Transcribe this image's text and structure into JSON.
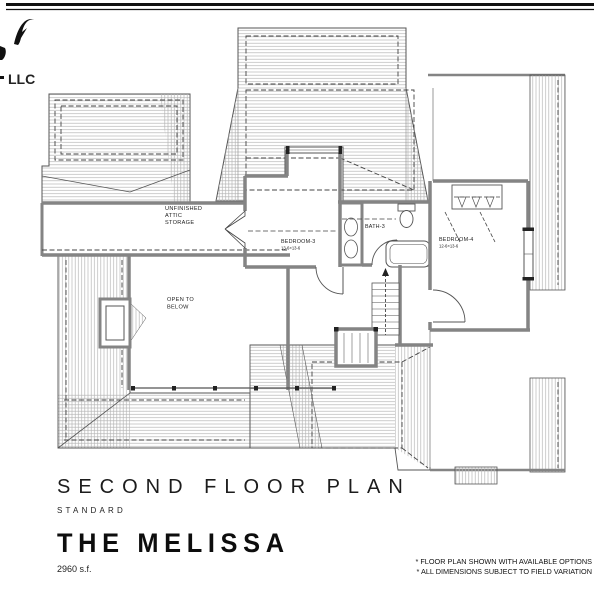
{
  "page": {
    "logo_suffix": "LLC",
    "title": "SECOND FLOOR PLAN",
    "subtitle": "STANDARD",
    "plan_name": "THE MELISSA",
    "area": "2960 s.f.",
    "notes": [
      "* FLOOR PLAN SHOWN WITH AVAILABLE OPTIONS",
      "* ALL DIMENSIONS SUBJECT TO FIELD VARIATION"
    ]
  },
  "rooms": {
    "attic": {
      "l1": "UNFINISHED",
      "l2": "ATTIC",
      "l3": "STORAGE"
    },
    "open_below": {
      "l1": "OPEN TO",
      "l2": "BELOW"
    },
    "bedroom3": {
      "name": "BEDROOM-3",
      "dims": "13-6×13-6"
    },
    "bath3": {
      "name": "BATH-3"
    },
    "bedroom4": {
      "name": "BEDROOM-4",
      "dims": "12-6×13-6"
    }
  },
  "colors": {
    "ink": "#1a1a1a",
    "wall": "#848484",
    "hatch": "#b5b5b5",
    "outline": "#555555"
  }
}
